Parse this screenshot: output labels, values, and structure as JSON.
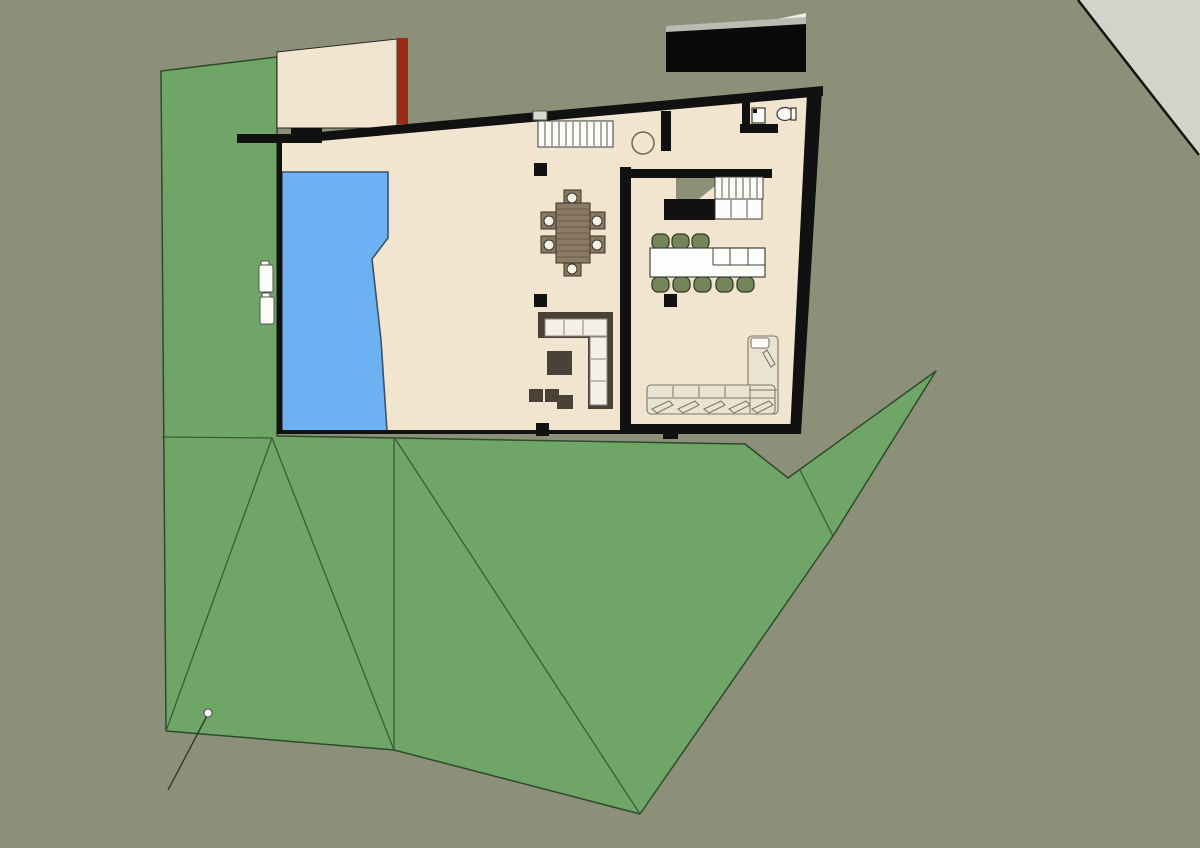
{
  "scene": {
    "description": "top-down architectural site plan render of a flat-roof house with pool, lawn terrain and curved road edge",
    "colors": {
      "background": "#8C9078",
      "road": "#D2D4CA",
      "terrain_green": "#6FA566",
      "terrain_line": "#3E5A39",
      "floor_cream": "#F2E5D0",
      "wall_black": "#111111",
      "terrace_edge": "#1d1d1a",
      "accent_wall_red": "#9B2A16",
      "roof_black": "#0A0A0A",
      "roof_edge_gray": "#B9BCB2",
      "roof_highlight": "#EFEFEA",
      "outdoor_step": "#D8D8CE",
      "pool_blue": "#6CB1F1",
      "stair_white": "#FCFCFA",
      "landing_olive": "#8B9077",
      "counter_white": "#FDFDFB",
      "stool_green": "#75855A",
      "wood_brown": "#8A7963",
      "sofa_dark": "#4B4237",
      "cushion_white": "#F3F0E6",
      "sectional_cream": "#E9E3D2",
      "fixture_white": "#FBFBF8",
      "marker_white": "#FFFFFF"
    },
    "objects": {
      "pool": "swimming pool",
      "roof_slab": "detached black roof slab",
      "courtyard": "upper courtyard with red accent wall",
      "main_stairs": "straight stair, 11 treads",
      "kitchen_stairs": "secondary stair with olive landing",
      "dining_set": "square table with 6 chairs",
      "island": "kitchen island with 8 green stools",
      "l_sofa": "dark L-shaped sofa with white cushions",
      "sectional": "cream L-shaped sectional sofa",
      "bathroom": "WC with sink and toilet",
      "site_marker": "white survey point with leader line"
    }
  }
}
